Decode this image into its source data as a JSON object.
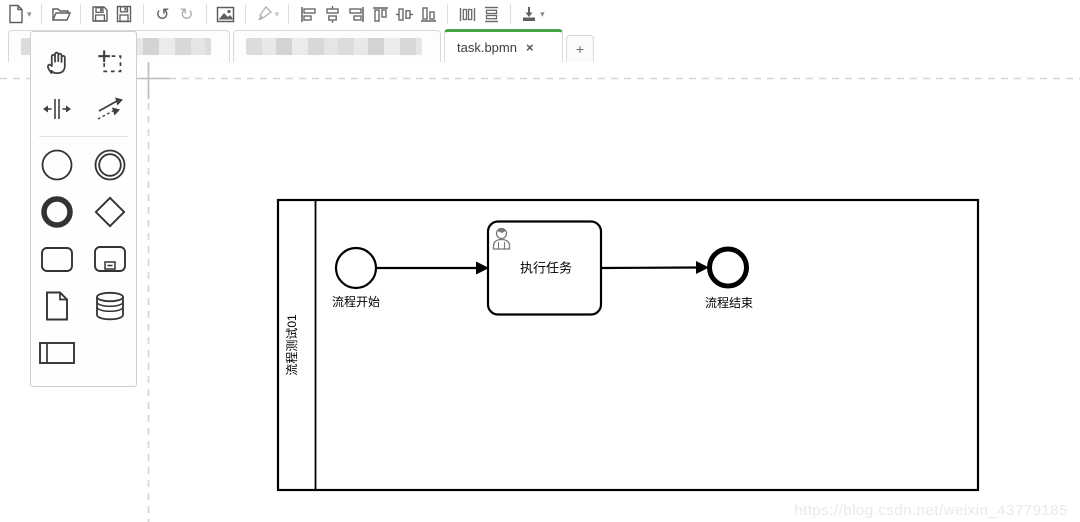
{
  "toolbar": {
    "caret_glyph": "▾",
    "undo_glyph": "↺",
    "redo_glyph": "↻",
    "items": [
      "new-file",
      "open-file",
      "save",
      "save-as",
      "undo",
      "redo",
      "export-image",
      "format-painter",
      "align-left",
      "align-vertical-center",
      "align-right",
      "align-top",
      "align-horizontal-center",
      "align-bottom",
      "distribute-horizontal",
      "distribute-vertical",
      "deploy-download"
    ]
  },
  "tabs": {
    "redacted": [
      {
        "label": ""
      },
      {
        "label": ""
      }
    ],
    "active": {
      "label": "task.bpmn",
      "close_glyph": "×"
    },
    "new_tab_label": "+"
  },
  "canvas": {
    "origin_label": "(0, 0)"
  },
  "palette": {
    "items": [
      "hand-tool",
      "lasso-tool",
      "space-tool",
      "global-connect-tool",
      "start-event",
      "intermediate-event",
      "end-event",
      "gateway",
      "task",
      "sub-process",
      "data-object",
      "data-store",
      "participant-pool"
    ]
  },
  "diagram": {
    "pool_label": "流程测试01",
    "start_label": "流程开始",
    "task_label": "执行任务",
    "end_label": "流程结束"
  },
  "watermark": {
    "text": "https://blog.csdn.net/weixin_43779185"
  },
  "colors": {
    "accent_green": "#46a546",
    "toolbar_icon": "#5f5f5f",
    "guide_gray": "#d6d6d6",
    "watermark_gray": "#e9e9e9"
  }
}
